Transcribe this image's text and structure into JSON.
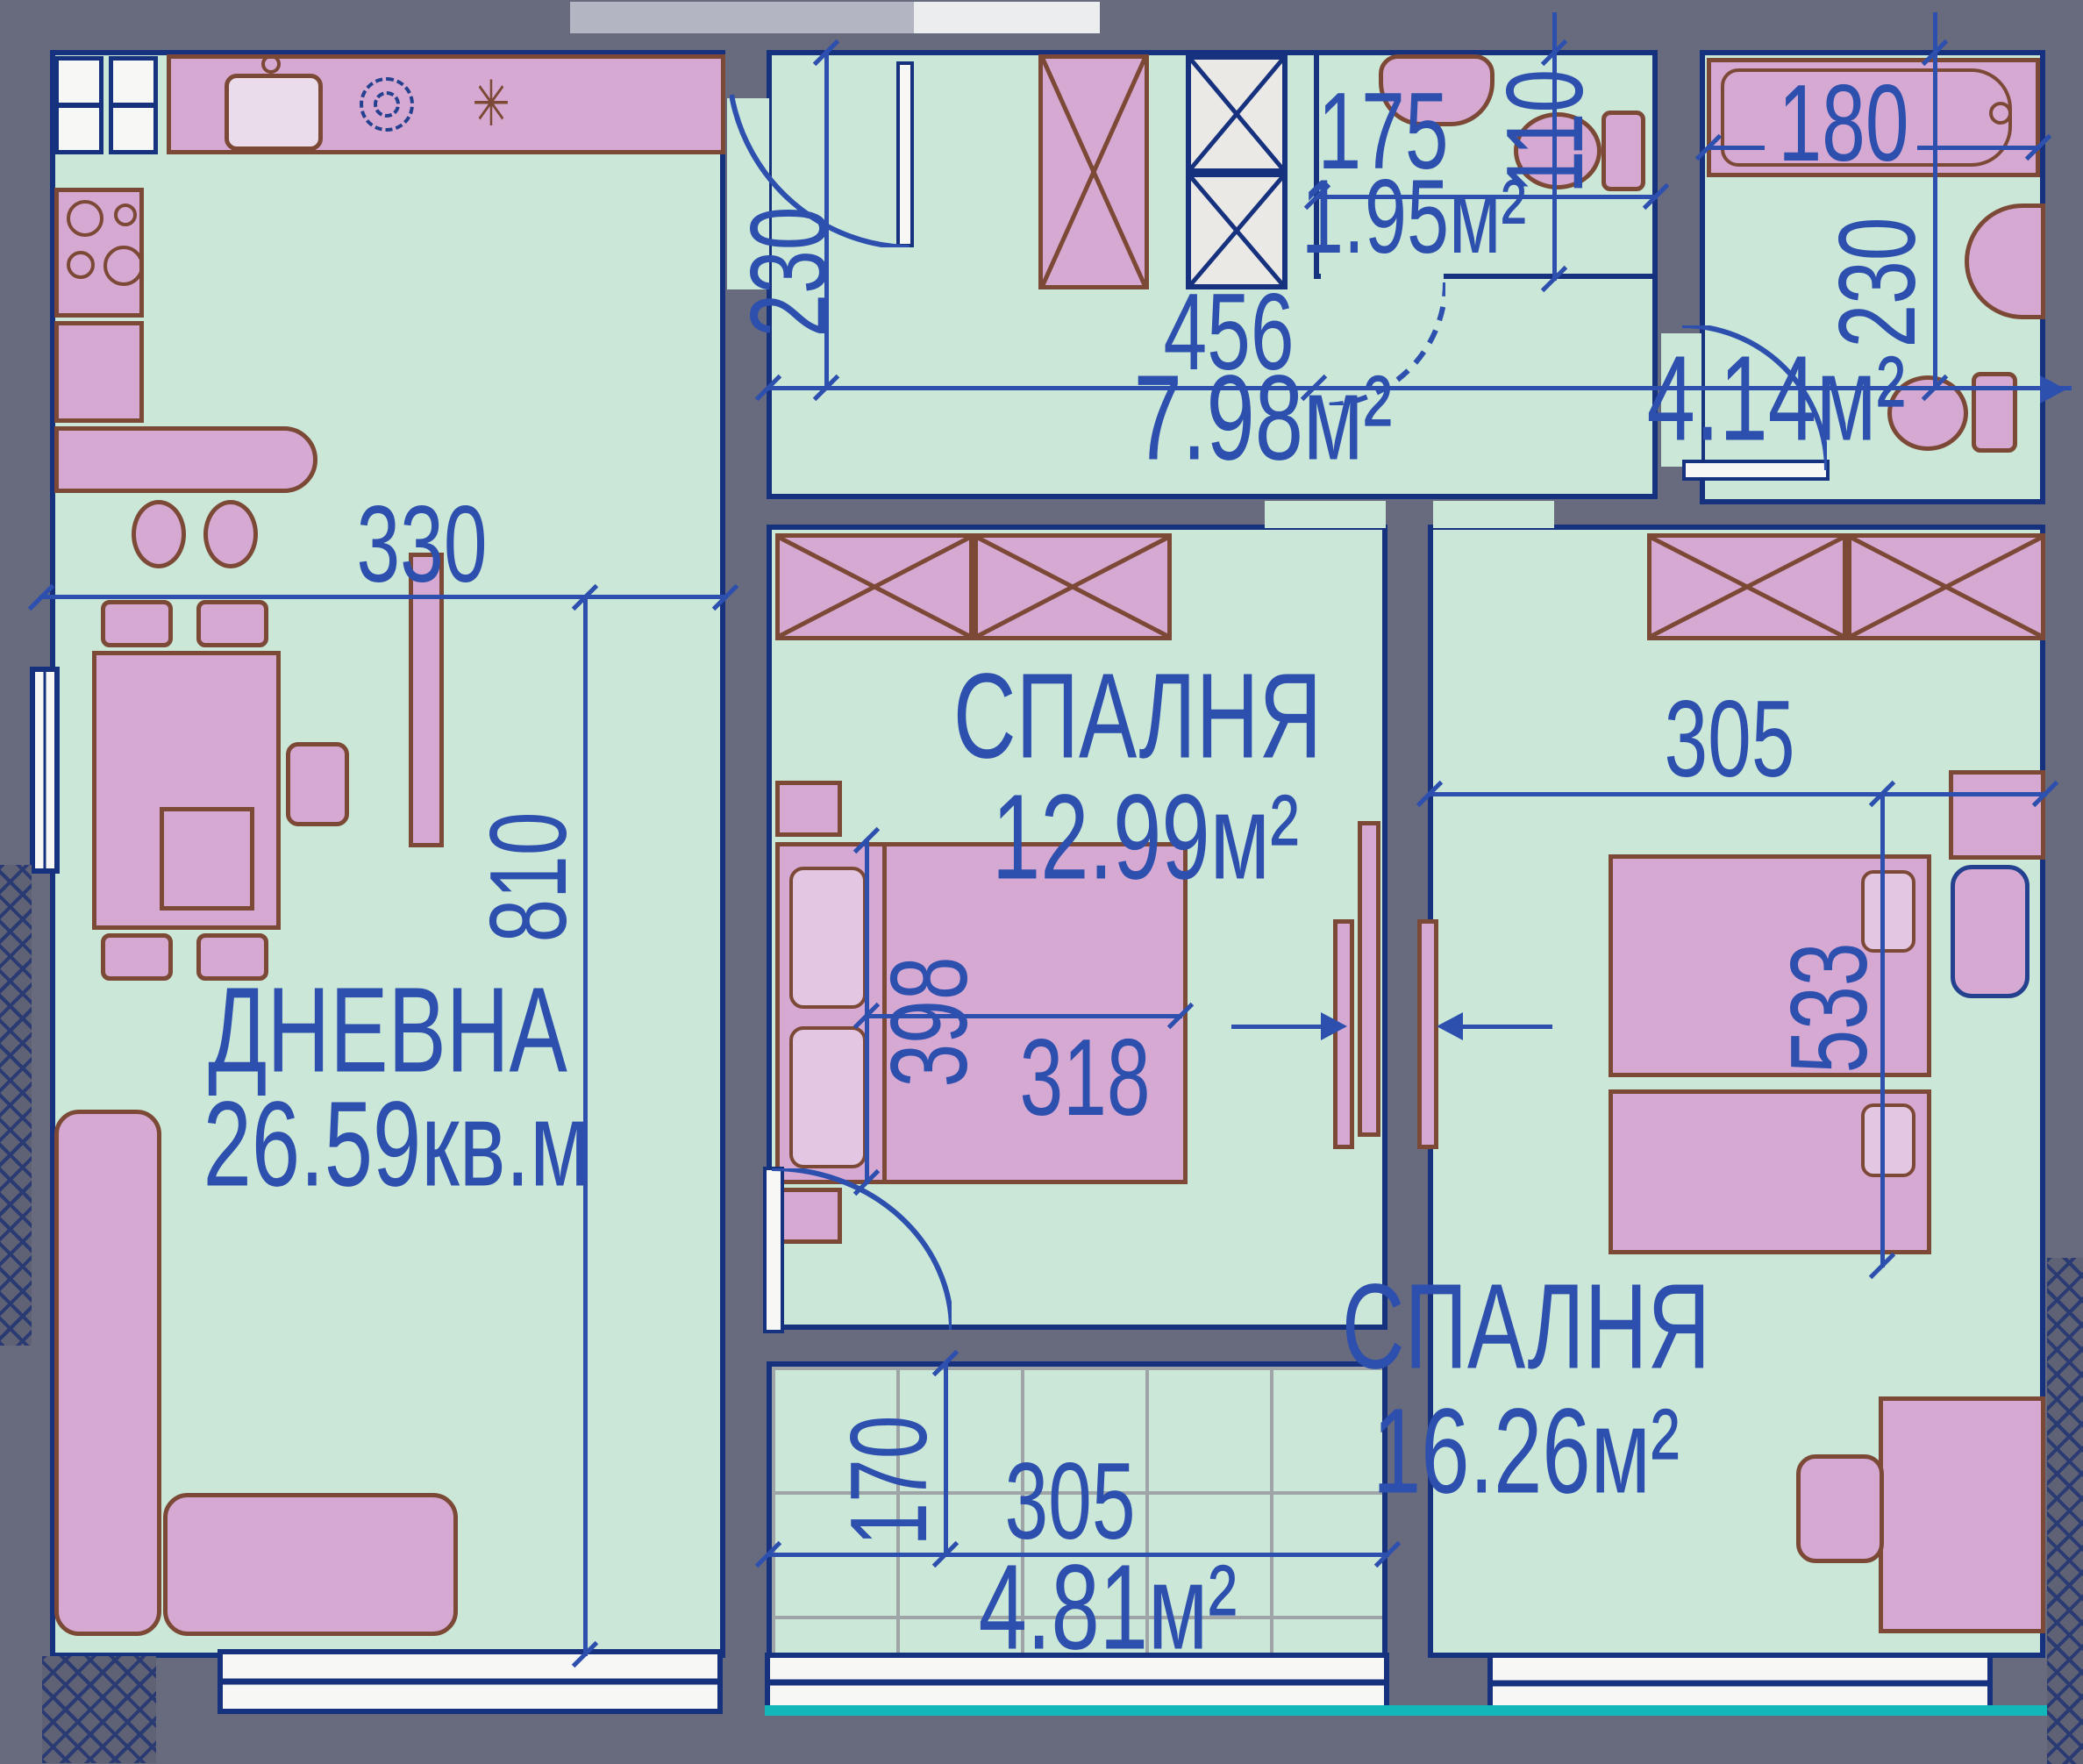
{
  "colors": {
    "wall": "#686a7e",
    "floor": "#cbe7d7",
    "furniture": "#d6a9d2",
    "furniture_outline": "#7c4936",
    "line_navy": "#16317d",
    "dimension_blue": "#2d4fae",
    "teal_sill": "#12b7ba"
  },
  "rooms": {
    "living": {
      "name": "ДНЕВНА",
      "area": "26.59кв.м",
      "width_cm": "330",
      "length_cm": "810"
    },
    "bedroom1": {
      "name": "СПАЛНЯ",
      "area": "12.99м²",
      "bed_length_cm": "398",
      "bed_width_cm": "318"
    },
    "bedroom2": {
      "name": "СПАЛНЯ",
      "area": "16.26м²",
      "width_cm": "305",
      "length_cm": "533"
    },
    "hallway": {
      "area": "7.98м²",
      "width_cm": "456",
      "depth_cm": "230"
    },
    "wc": {
      "area": "1.95м²",
      "width_cm": "175",
      "depth_cm": "110"
    },
    "bathroom": {
      "area": "4.14м²",
      "tub_length_cm": "180",
      "depth_cm": "230"
    },
    "balcony": {
      "area": "4.81м²",
      "width_cm": "305",
      "depth_cm": "170"
    }
  },
  "icons": {
    "burner_asterisk": "✳"
  }
}
